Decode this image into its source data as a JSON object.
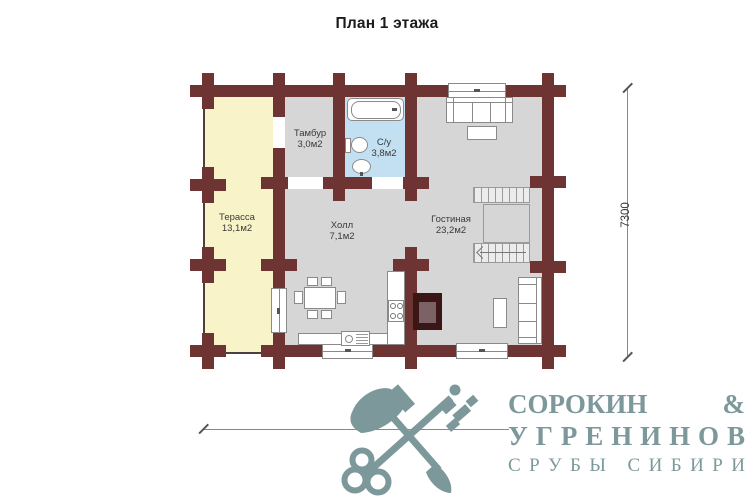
{
  "title": "План 1 этажа",
  "rooms": {
    "terrace": {
      "name": "Терасса",
      "area": "13,1м2"
    },
    "tambur": {
      "name": "Тамбур",
      "area": "3,0м2"
    },
    "bathroom": {
      "name": "С/у",
      "area": "3,8м2"
    },
    "hall": {
      "name": "Холл",
      "area": "7,1м2"
    },
    "living": {
      "name": "Гостиная",
      "area": "23,2м2"
    }
  },
  "dimensions": {
    "vertical": "7300",
    "horizontal": "9300"
  },
  "logo": {
    "name_top": "СОРОКИН",
    "ampersand": "&",
    "name_bottom": "УГРЕНИНОВ",
    "tagline": "СРУБЫ СИБИРИ"
  },
  "colors": {
    "wall": "#6e3434",
    "terrace_floor": "#f8f3c8",
    "interior_floor": "#d6d6d6",
    "bathroom_floor": "#c2e0f2",
    "fireplace_outer": "#3a1617",
    "fireplace_inner": "#7c6165",
    "logo": "#7d989b",
    "furniture_line": "#8a8a8a"
  }
}
